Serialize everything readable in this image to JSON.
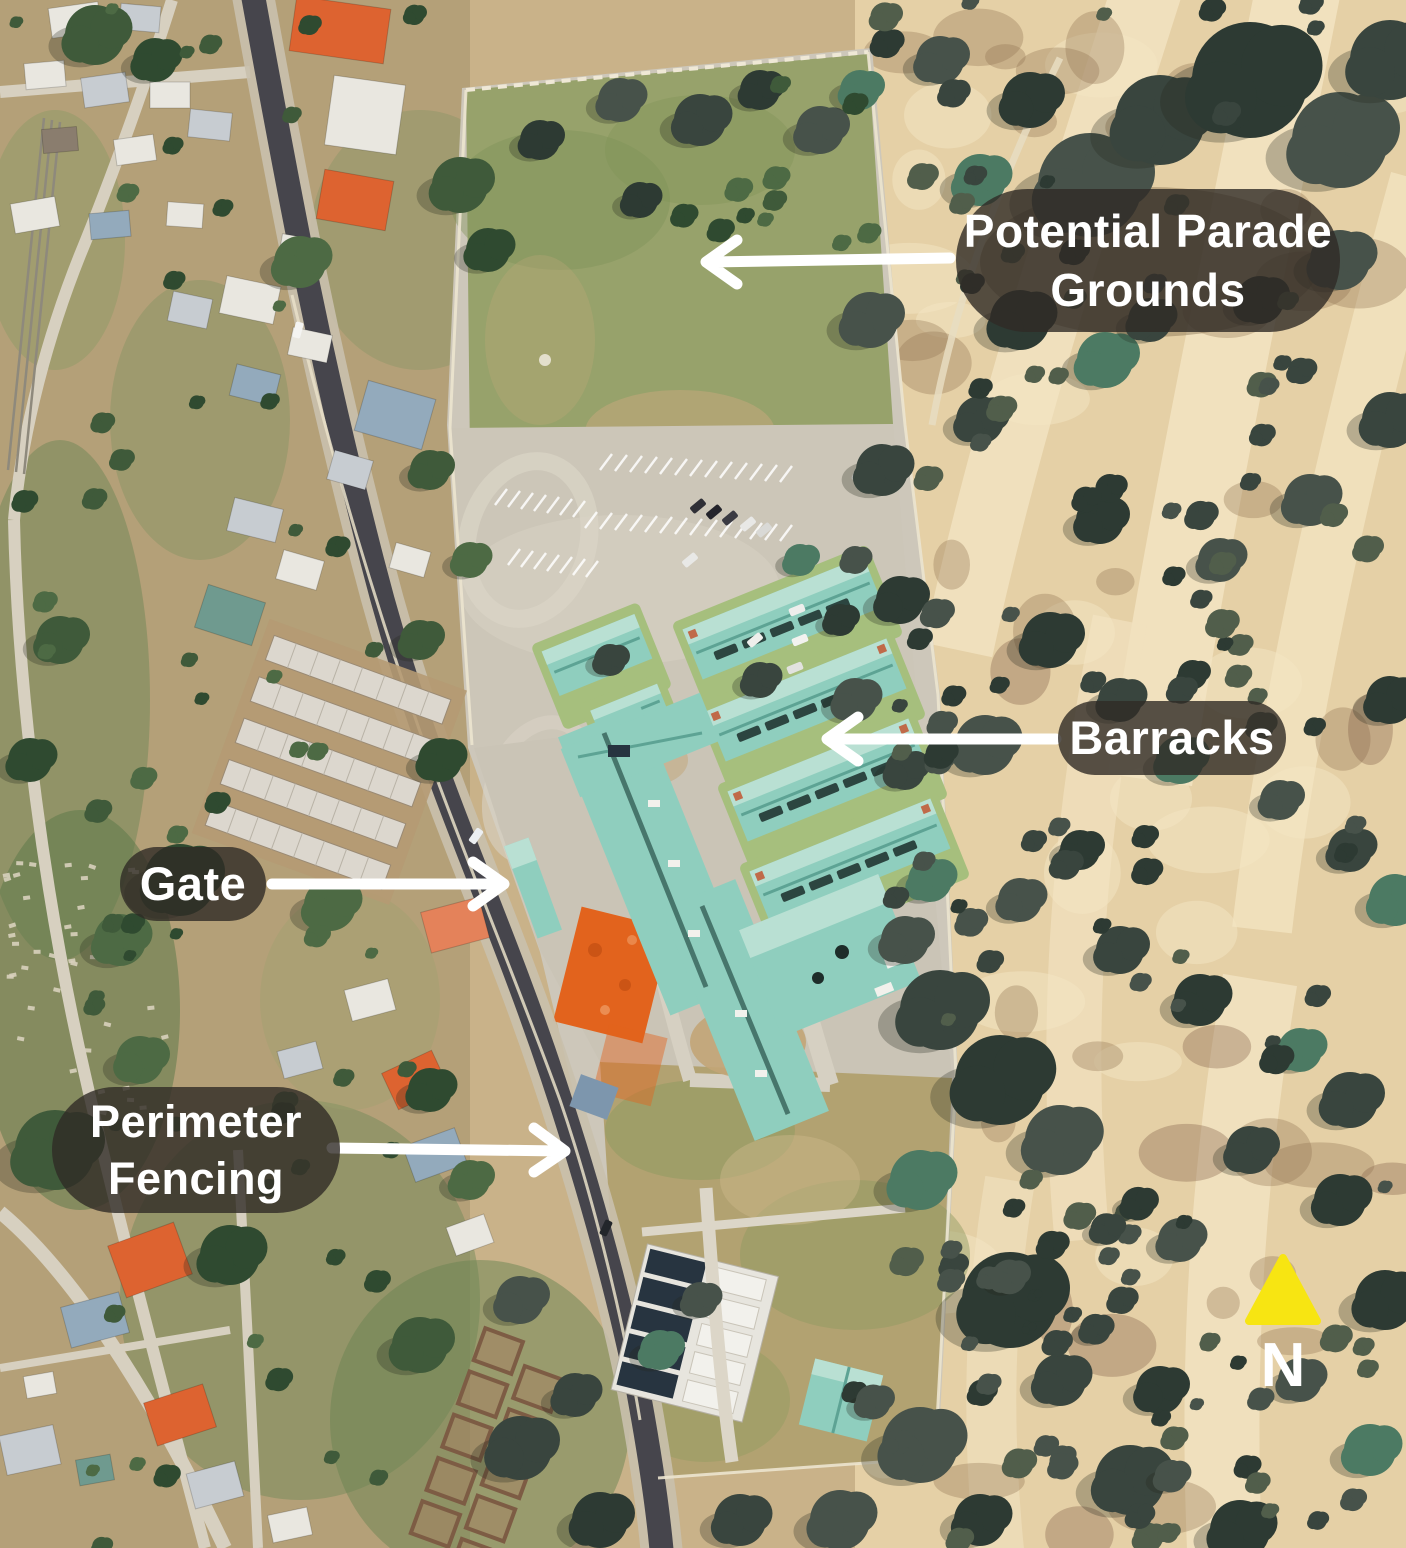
{
  "annotations": {
    "parade": {
      "line1": "Potential Parade",
      "line2": "Grounds"
    },
    "barracks": {
      "label": "Barracks"
    },
    "gate": {
      "label": "Gate"
    },
    "perimeter": {
      "line1": "Perimeter",
      "line2": "Fencing"
    }
  },
  "compass": {
    "label": "N"
  },
  "colors": {
    "pill_bg": "rgba(47,43,37,0.8)",
    "annotation_text": "#ffffff",
    "arrow": "#ffffff",
    "north_triangle": "#f7e512",
    "barracks_roof": "#8fcebe"
  }
}
